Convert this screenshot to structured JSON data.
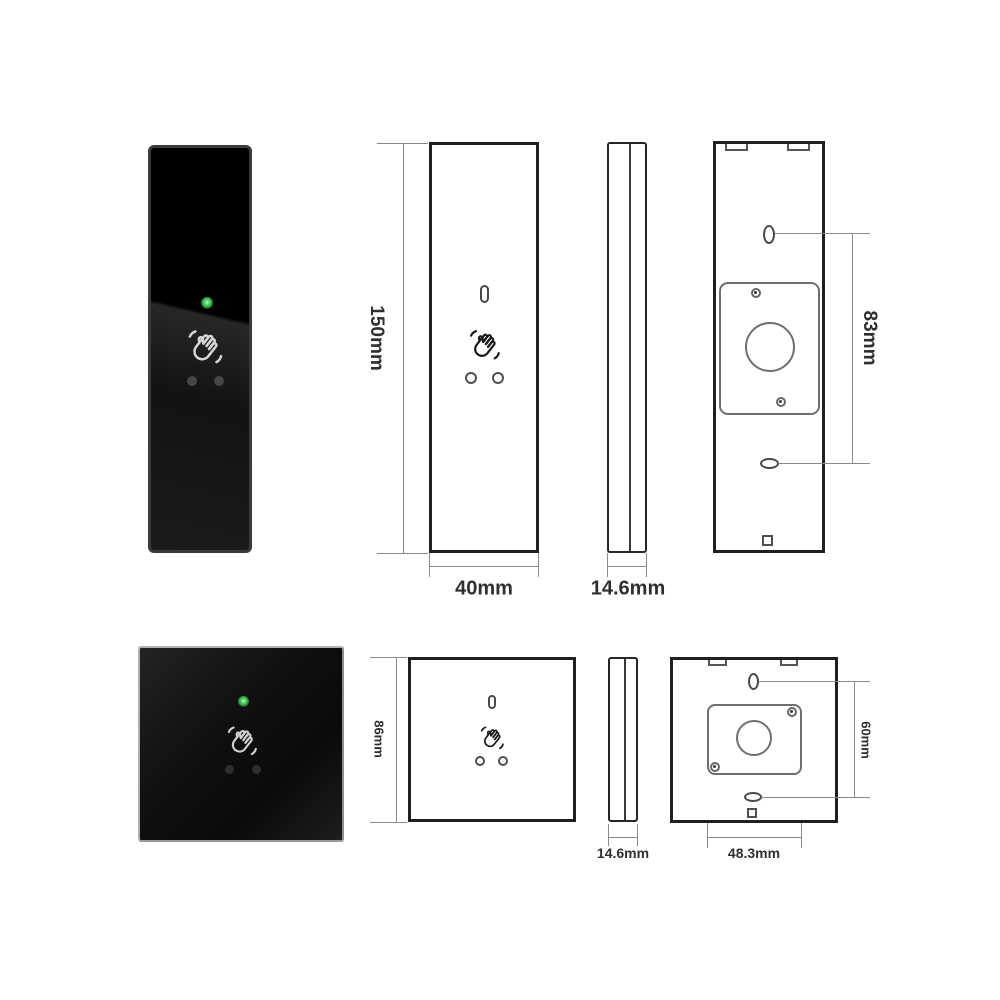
{
  "sheet": {
    "background": "#ffffff",
    "outline_color": "#1f1f1f",
    "dimension_line_color": "#8a8a8a",
    "led_color": "#35b54a",
    "product_color": "#0d0d0d",
    "icons": [
      "hand-wave-icon",
      "led-indicator",
      "screw-hole-icon",
      "wire-hole-slot",
      "mounting-plate"
    ]
  },
  "top_row": {
    "height_label": "150mm",
    "width_label": "40mm",
    "depth_label": "14.6mm",
    "hole_spacing_label": "83mm"
  },
  "bottom_row": {
    "height_label": "86mm",
    "depth_label": "14.6mm",
    "hole_spacing_label": "60mm",
    "plate_width_label": "48.3mm"
  }
}
